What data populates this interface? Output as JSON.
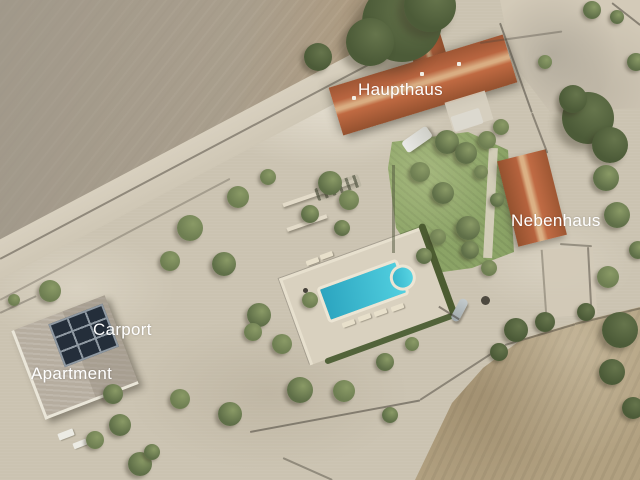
{
  "photo": {
    "description": "Aerial photograph of a rural estate with main house, secondary house, apartment building with carport, swimming pool, gravel grounds and olive trees, surrounded by dry fields",
    "annotations": {
      "haupthaus": "Haupthaus",
      "nebenhaus": "Nebenhaus",
      "carport": "Carport",
      "apartment": "Apartment"
    },
    "colors": {
      "label_text": "#ffffff",
      "roof_terracotta": "#bb6743",
      "flat_roof_grey": "#b6ad9f",
      "solar_panel": "#242e3a",
      "pool_water": "#3fc3d7",
      "pool_coping": "#ece5d4",
      "gravel": "#cbc3b1",
      "field_plowed": "#a89e8d",
      "field_dry": "#b2a181",
      "lawn_green": "#8ba366",
      "tree_green": "#5f6f48",
      "hedge_green": "#4c5c31"
    }
  }
}
